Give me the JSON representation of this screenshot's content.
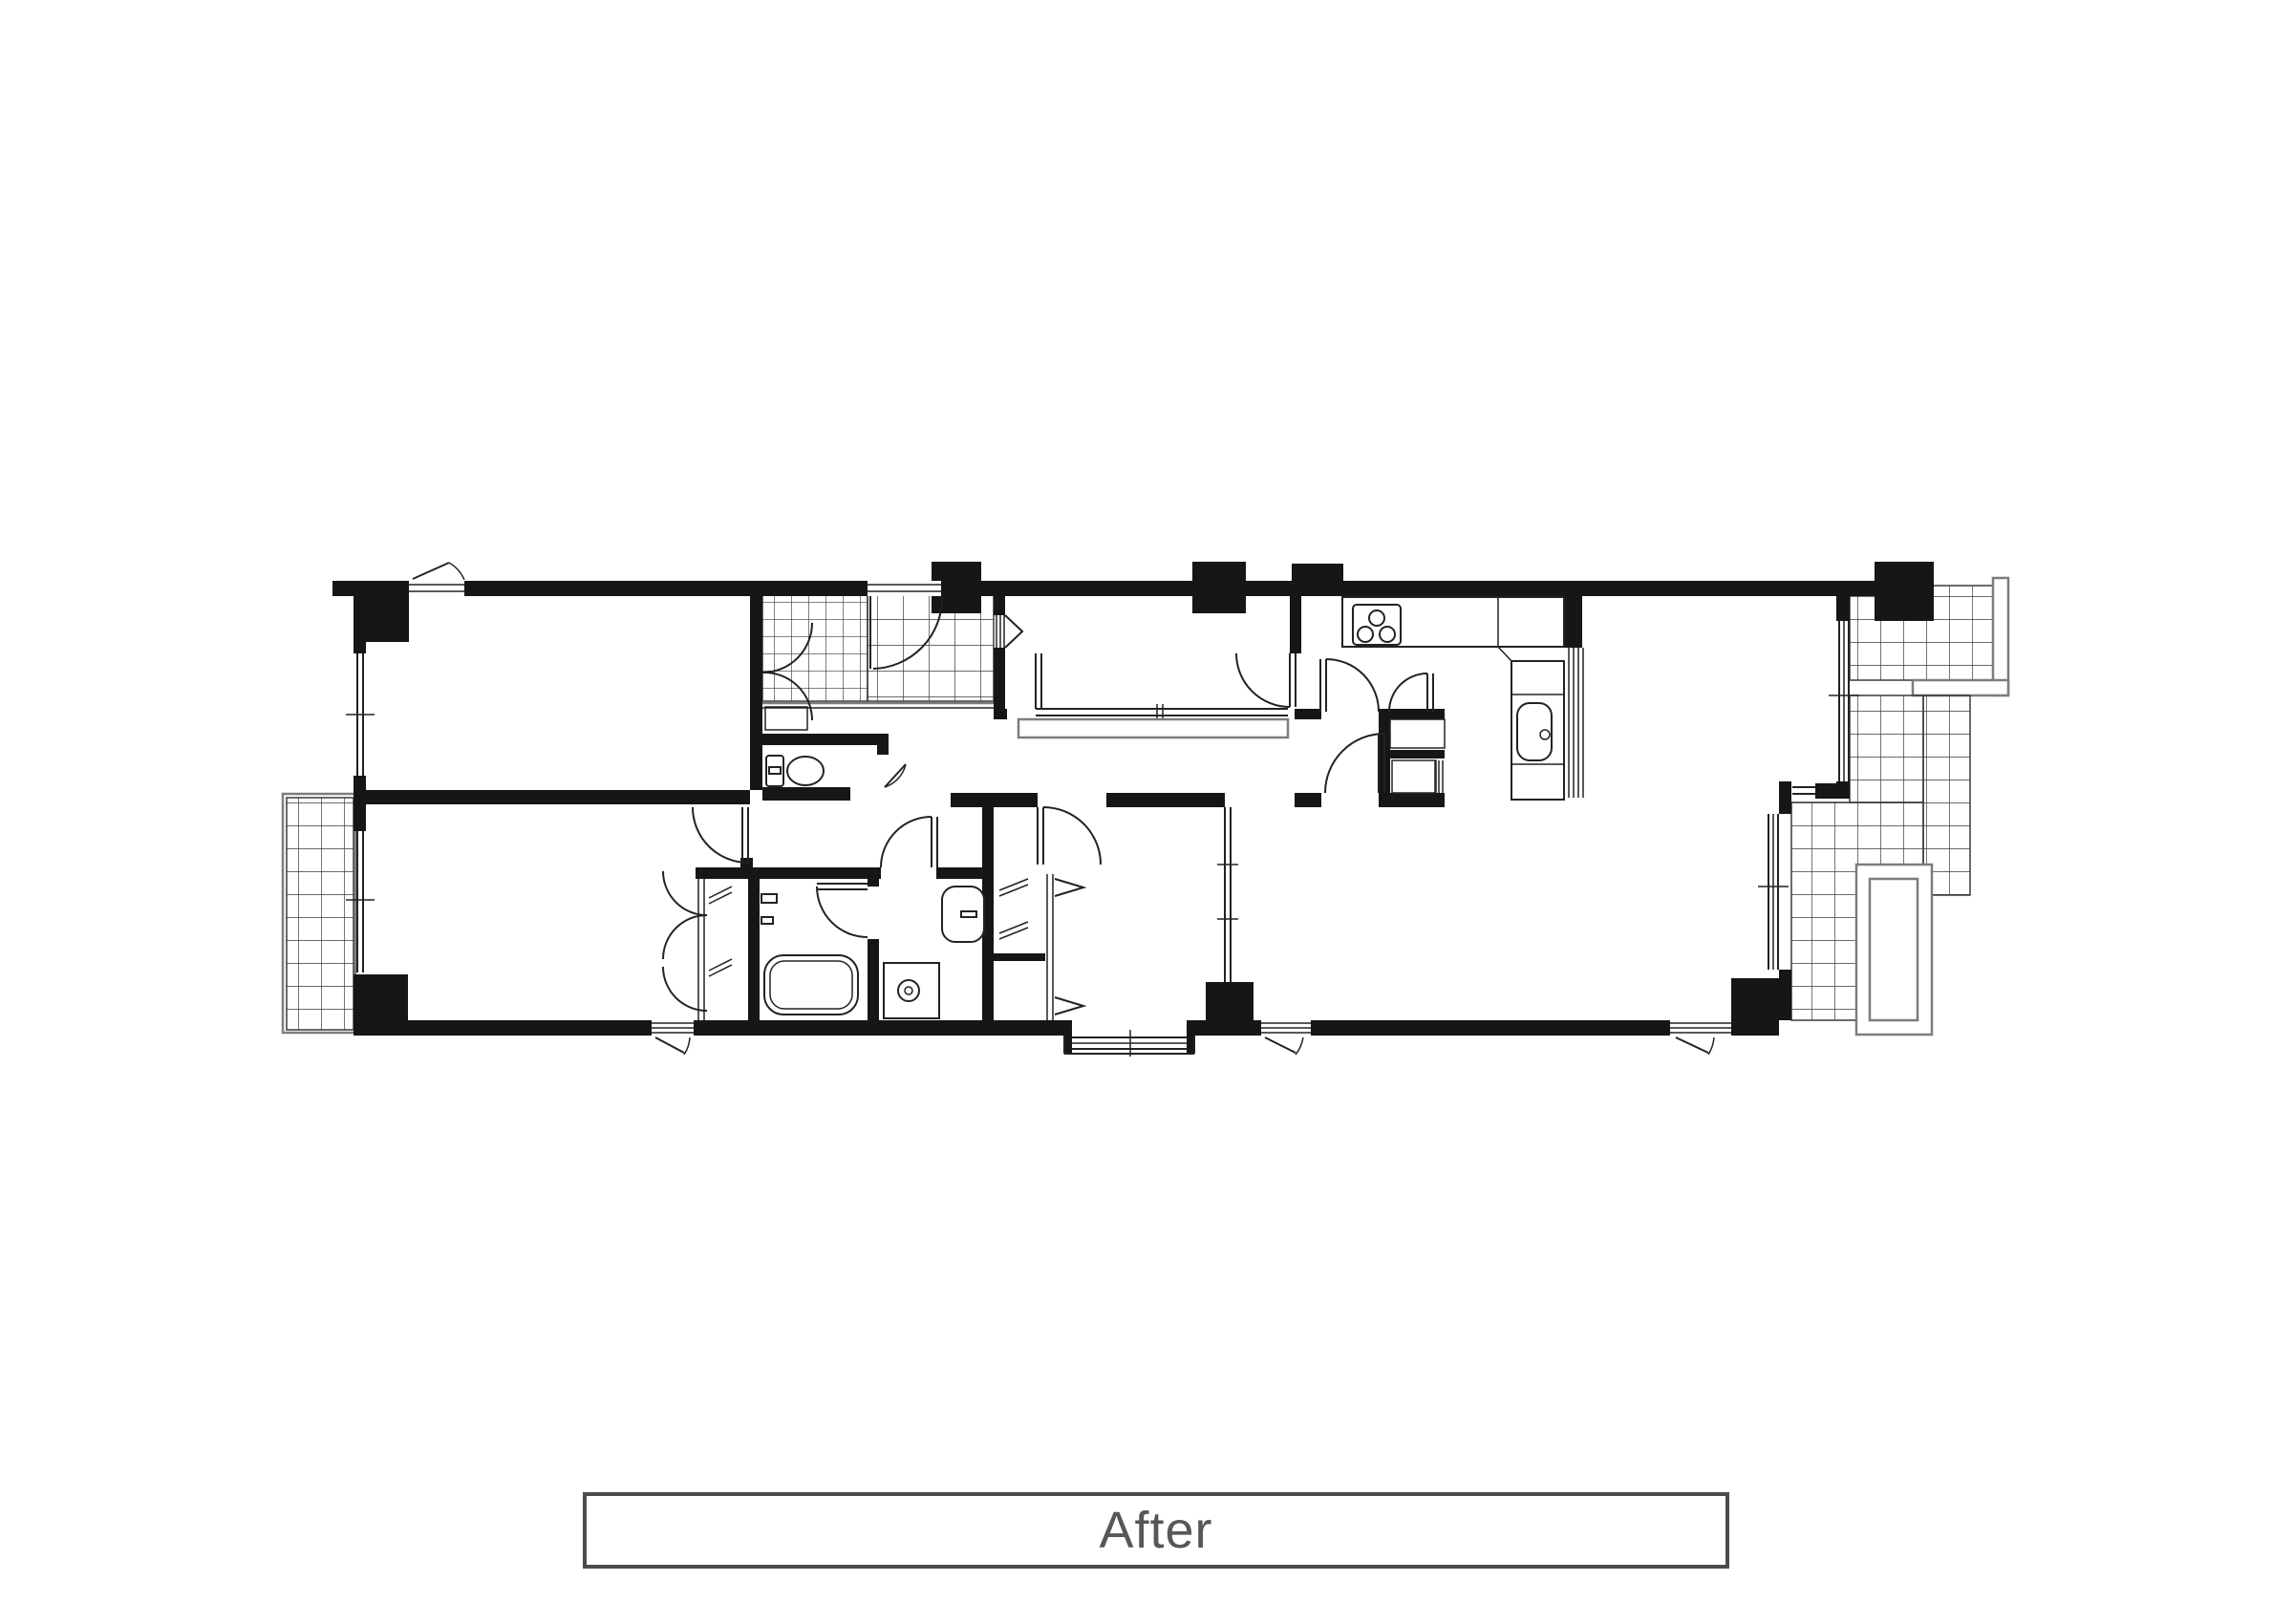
{
  "caption": {
    "label": "After"
  },
  "palette": {
    "wall": "#161616",
    "line": "#222222",
    "tile_line": "#3a3a3a",
    "grid_accent": "#7d7d7d",
    "caption_border": "#4c4c4c",
    "caption_text": "#575757",
    "background": "#ffffff"
  },
  "plan": {
    "type": "apartment-floor-plan",
    "style": "black-and-white architectural line drawing, no room labels",
    "regions": [
      "bedroom-top-left",
      "bedroom-bottom-left",
      "entrance-hall-tiled",
      "toilet-room",
      "front-room-with-sliding-partition",
      "hallway",
      "washroom",
      "bathroom",
      "linen-closet",
      "bedroom-center",
      "closet-bifold",
      "kitchen",
      "living-dining",
      "balcony-left-tiled",
      "balcony-right-upper-tiled",
      "balcony-right-lower-tiled"
    ],
    "fixture_icons": [
      "bathtub-icon",
      "toilet-icon",
      "washbasin-icon",
      "washing-machine-pan-icon",
      "kitchen-stove-3-burners-icon",
      "kitchen-sink-icon",
      "door-swing-arc-icon",
      "sliding-window-icon",
      "bifold-closet-chevron-icon",
      "tile-grid-icon",
      "planter-box-icon"
    ]
  }
}
